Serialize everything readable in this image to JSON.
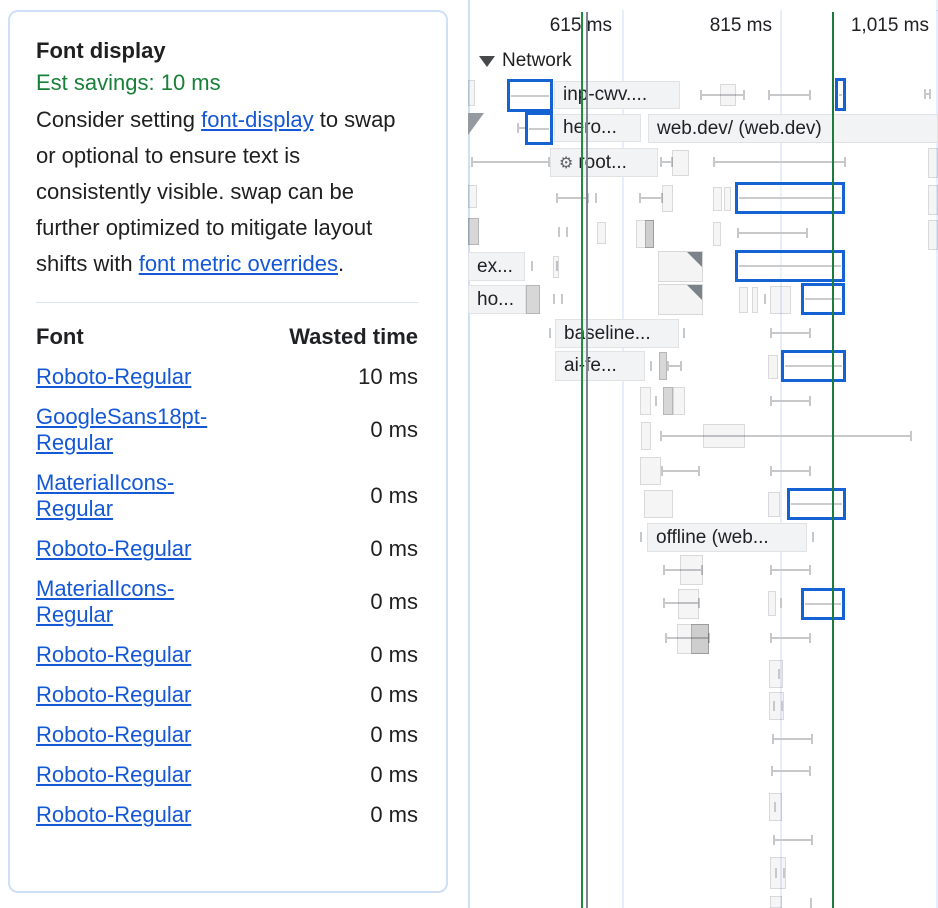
{
  "tooltip": {
    "title": "Font display",
    "savings": "Est savings: 10 ms",
    "description_parts": [
      {
        "text": "Consider setting "
      },
      {
        "text": "font-display",
        "link": true
      },
      {
        "text": " to swap or optional to ensure text is consistently visible. swap can be further optimized to mitigate layout shifts with "
      },
      {
        "text": "font metric overrides",
        "link": true
      },
      {
        "text": "."
      }
    ],
    "table": {
      "headers": [
        "Font",
        "Wasted time"
      ],
      "rows": [
        {
          "font": "Roboto-Regular",
          "wasted": "10 ms"
        },
        {
          "font": "GoogleSans18pt-Regular",
          "wasted": "0 ms"
        },
        {
          "font": "MaterialIcons-Regular",
          "wasted": "0 ms"
        },
        {
          "font": "Roboto-Regular",
          "wasted": "0 ms"
        },
        {
          "font": "MaterialIcons-Regular",
          "wasted": "0 ms"
        },
        {
          "font": "Roboto-Regular",
          "wasted": "0 ms"
        },
        {
          "font": "Roboto-Regular",
          "wasted": "0 ms"
        },
        {
          "font": "Roboto-Regular",
          "wasted": "0 ms"
        },
        {
          "font": "Roboto-Regular",
          "wasted": "0 ms"
        },
        {
          "font": "Roboto-Regular",
          "wasted": "0 ms"
        }
      ]
    },
    "colors": {
      "savings_green": "#188038",
      "link_blue": "#1558d6",
      "card_border": "#cfdff7"
    }
  },
  "timeline": {
    "track": {
      "name": "Network",
      "collapsed": false
    },
    "ruler": [
      {
        "label": "615 ms",
        "x": 620
      },
      {
        "label": "815 ms",
        "x": 780
      },
      {
        "label": "1,015 ms",
        "x": 937
      }
    ],
    "gridlines": [
      622,
      780,
      936
    ],
    "markers": [
      {
        "x": 581,
        "color": "#1e8e3e"
      },
      {
        "x": 586,
        "color": "#7d8590"
      },
      {
        "x": 832,
        "color": "#1b7d3c"
      }
    ],
    "minimap_dividers": [
      553,
      597,
      644,
      730,
      857
    ],
    "highlight_blue": "#1563d3",
    "items": [
      {
        "t": "req",
        "x": 468,
        "y": 80,
        "w": 7,
        "h": 26
      },
      {
        "t": "blue",
        "x": 507,
        "y": 79,
        "w": 46,
        "h": 33
      },
      {
        "t": "label",
        "x": 554,
        "y": 81,
        "w": 126,
        "h": 28,
        "text": "inp-cwv...."
      },
      {
        "t": "whisk",
        "x": 700,
        "x2": 745,
        "y": 95
      },
      {
        "t": "req",
        "x": 720,
        "y": 84,
        "w": 16,
        "h": 22
      },
      {
        "t": "whisk",
        "x": 768,
        "x2": 811,
        "y": 95
      },
      {
        "t": "blue",
        "x": 835,
        "y": 78,
        "w": 11,
        "h": 33
      },
      {
        "t": "whisk",
        "x": 924,
        "x2": 931,
        "y": 94
      },
      {
        "t": "tri",
        "x": 468,
        "y": 113
      },
      {
        "t": "whisk",
        "x": 517,
        "x2": 527,
        "y": 128
      },
      {
        "t": "blue",
        "x": 525,
        "y": 112,
        "w": 28,
        "h": 33
      },
      {
        "t": "label",
        "x": 554,
        "y": 114,
        "w": 87,
        "h": 28,
        "text": "hero..."
      },
      {
        "t": "label",
        "x": 648,
        "y": 114,
        "w": 290,
        "h": 29,
        "text": "web.dev/ (web.dev)"
      },
      {
        "t": "whisk",
        "x": 471,
        "x2": 550,
        "y": 162
      },
      {
        "t": "label",
        "x": 550,
        "y": 148,
        "w": 108,
        "h": 29,
        "text": "root...",
        "icon": "gear"
      },
      {
        "t": "whisk",
        "x": 660,
        "x2": 673,
        "y": 162
      },
      {
        "t": "req",
        "x": 672,
        "y": 150,
        "w": 17,
        "h": 26
      },
      {
        "t": "whisk",
        "x": 713,
        "x2": 846,
        "y": 162
      },
      {
        "t": "req",
        "x": 928,
        "y": 148,
        "w": 10,
        "h": 30
      },
      {
        "t": "req",
        "x": 468,
        "y": 185,
        "w": 9,
        "h": 23
      },
      {
        "t": "whisk",
        "x": 556,
        "x2": 589,
        "y": 198
      },
      {
        "t": "tick",
        "x": 595,
        "y": 198
      },
      {
        "t": "whisk",
        "x": 639,
        "x2": 663,
        "y": 198
      },
      {
        "t": "req",
        "x": 662,
        "y": 185,
        "w": 11,
        "h": 27
      },
      {
        "t": "req",
        "x": 713,
        "y": 187,
        "w": 9,
        "h": 24
      },
      {
        "t": "req",
        "x": 724,
        "y": 187,
        "w": 7,
        "h": 24
      },
      {
        "t": "blue",
        "x": 735,
        "y": 182,
        "w": 110,
        "h": 32
      },
      {
        "t": "req",
        "x": 928,
        "y": 185,
        "w": 10,
        "h": 30
      },
      {
        "t": "reqd",
        "x": 468,
        "y": 218,
        "w": 11,
        "h": 27
      },
      {
        "t": "tick",
        "x": 558,
        "y": 232
      },
      {
        "t": "tick",
        "x": 566,
        "y": 232
      },
      {
        "t": "req",
        "x": 597,
        "y": 222,
        "w": 9,
        "h": 22
      },
      {
        "t": "req",
        "x": 636,
        "y": 220,
        "w": 18,
        "h": 28
      },
      {
        "t": "reqd",
        "x": 645,
        "y": 220,
        "w": 9,
        "h": 28
      },
      {
        "t": "req",
        "x": 713,
        "y": 222,
        "w": 8,
        "h": 24
      },
      {
        "t": "whisk",
        "x": 737,
        "x2": 808,
        "y": 233
      },
      {
        "t": "req",
        "x": 928,
        "y": 220,
        "w": 10,
        "h": 30
      },
      {
        "t": "label",
        "x": 468,
        "y": 252,
        "w": 57,
        "h": 29,
        "text": "ex..."
      },
      {
        "t": "tick",
        "x": 531,
        "y": 266
      },
      {
        "t": "tick",
        "x": 556,
        "y": 266
      },
      {
        "t": "req",
        "x": 553,
        "y": 256,
        "w": 6,
        "h": 22
      },
      {
        "t": "corner",
        "x": 658,
        "y": 251,
        "w": 45,
        "h": 31
      },
      {
        "t": "blue",
        "x": 735,
        "y": 250,
        "w": 110,
        "h": 32
      },
      {
        "t": "label",
        "x": 468,
        "y": 285,
        "w": 58,
        "h": 29,
        "text": "ho..."
      },
      {
        "t": "reqd",
        "x": 526,
        "y": 285,
        "w": 14,
        "h": 29
      },
      {
        "t": "tick",
        "x": 553,
        "y": 299
      },
      {
        "t": "tick",
        "x": 561,
        "y": 299
      },
      {
        "t": "corner",
        "x": 658,
        "y": 284,
        "w": 45,
        "h": 31
      },
      {
        "t": "req",
        "x": 739,
        "y": 287,
        "w": 9,
        "h": 26
      },
      {
        "t": "req",
        "x": 752,
        "y": 287,
        "w": 6,
        "h": 26
      },
      {
        "t": "tick",
        "x": 764,
        "y": 299
      },
      {
        "t": "req",
        "x": 770,
        "y": 286,
        "w": 21,
        "h": 28
      },
      {
        "t": "blue",
        "x": 801,
        "y": 283,
        "w": 44,
        "h": 32
      },
      {
        "t": "tick",
        "x": 549,
        "y": 333
      },
      {
        "t": "label",
        "x": 555,
        "y": 319,
        "w": 124,
        "h": 29,
        "text": "baseline..."
      },
      {
        "t": "tick",
        "x": 683,
        "y": 333
      },
      {
        "t": "whisk",
        "x": 770,
        "x2": 811,
        "y": 333
      },
      {
        "t": "label",
        "x": 555,
        "y": 351,
        "w": 90,
        "h": 30,
        "text": "ai-fe..."
      },
      {
        "t": "tick",
        "x": 650,
        "y": 366
      },
      {
        "t": "reqd",
        "x": 659,
        "y": 352,
        "w": 8,
        "h": 28
      },
      {
        "t": "whisk",
        "x": 667,
        "x2": 682,
        "y": 366
      },
      {
        "t": "req",
        "x": 768,
        "y": 355,
        "w": 10,
        "h": 24
      },
      {
        "t": "blue",
        "x": 781,
        "y": 350,
        "w": 65,
        "h": 32
      },
      {
        "t": "req",
        "x": 640,
        "y": 387,
        "w": 11,
        "h": 28
      },
      {
        "t": "tick",
        "x": 655,
        "y": 401
      },
      {
        "t": "reqd",
        "x": 663,
        "y": 387,
        "w": 10,
        "h": 28
      },
      {
        "t": "req",
        "x": 673,
        "y": 387,
        "w": 12,
        "h": 28
      },
      {
        "t": "whisk",
        "x": 770,
        "x2": 811,
        "y": 401
      },
      {
        "t": "req",
        "x": 641,
        "y": 422,
        "w": 10,
        "h": 28
      },
      {
        "t": "whisk",
        "x": 660,
        "x2": 912,
        "y": 436
      },
      {
        "t": "req",
        "x": 703,
        "y": 424,
        "w": 42,
        "h": 24
      },
      {
        "t": "req",
        "x": 640,
        "y": 457,
        "w": 21,
        "h": 28
      },
      {
        "t": "whisk",
        "x": 661,
        "x2": 700,
        "y": 471
      },
      {
        "t": "whisk",
        "x": 770,
        "x2": 811,
        "y": 471
      },
      {
        "t": "req",
        "x": 644,
        "y": 490,
        "w": 29,
        "h": 28
      },
      {
        "t": "req",
        "x": 768,
        "y": 492,
        "w": 12,
        "h": 25
      },
      {
        "t": "blue",
        "x": 787,
        "y": 488,
        "w": 59,
        "h": 32
      },
      {
        "t": "tick",
        "x": 640,
        "y": 537
      },
      {
        "t": "label",
        "x": 647,
        "y": 523,
        "w": 160,
        "h": 29,
        "text": "offline (web..."
      },
      {
        "t": "tick",
        "x": 812,
        "y": 537
      },
      {
        "t": "whisk",
        "x": 663,
        "x2": 703,
        "y": 570
      },
      {
        "t": "req",
        "x": 680,
        "y": 555,
        "w": 23,
        "h": 30
      },
      {
        "t": "whisk",
        "x": 770,
        "x2": 811,
        "y": 570
      },
      {
        "t": "whisk",
        "x": 663,
        "x2": 700,
        "y": 603
      },
      {
        "t": "req",
        "x": 678,
        "y": 589,
        "w": 21,
        "h": 30
      },
      {
        "t": "req",
        "x": 768,
        "y": 591,
        "w": 8,
        "h": 25
      },
      {
        "t": "tick",
        "x": 780,
        "y": 603
      },
      {
        "t": "blue",
        "x": 801,
        "y": 588,
        "w": 44,
        "h": 32
      },
      {
        "t": "whisk",
        "x": 665,
        "x2": 710,
        "y": 638
      },
      {
        "t": "req",
        "x": 677,
        "y": 624,
        "w": 32,
        "h": 30
      },
      {
        "t": "reqd",
        "x": 691,
        "y": 624,
        "w": 18,
        "h": 30
      },
      {
        "t": "whisk",
        "x": 770,
        "x2": 811,
        "y": 638
      },
      {
        "t": "req",
        "x": 769,
        "y": 660,
        "w": 14,
        "h": 28
      },
      {
        "t": "tick",
        "x": 778,
        "y": 674
      },
      {
        "t": "req",
        "x": 769,
        "y": 692,
        "w": 15,
        "h": 28
      },
      {
        "t": "tick",
        "x": 773,
        "y": 706
      },
      {
        "t": "tick",
        "x": 781,
        "y": 706
      },
      {
        "t": "whisk",
        "x": 772,
        "x2": 813,
        "y": 739
      },
      {
        "t": "whisk",
        "x": 771,
        "x2": 811,
        "y": 771
      },
      {
        "t": "req",
        "x": 769,
        "y": 793,
        "w": 13,
        "h": 28
      },
      {
        "t": "tick",
        "x": 774,
        "y": 807
      },
      {
        "t": "whisk",
        "x": 773,
        "x2": 813,
        "y": 840
      },
      {
        "t": "req",
        "x": 770,
        "y": 857,
        "w": 16,
        "h": 32
      },
      {
        "t": "tick",
        "x": 775,
        "y": 873
      },
      {
        "t": "tick",
        "x": 783,
        "y": 873
      },
      {
        "t": "req",
        "x": 770,
        "y": 896,
        "w": 12,
        "h": 12
      },
      {
        "t": "tick",
        "x": 810,
        "y": 903
      }
    ]
  }
}
